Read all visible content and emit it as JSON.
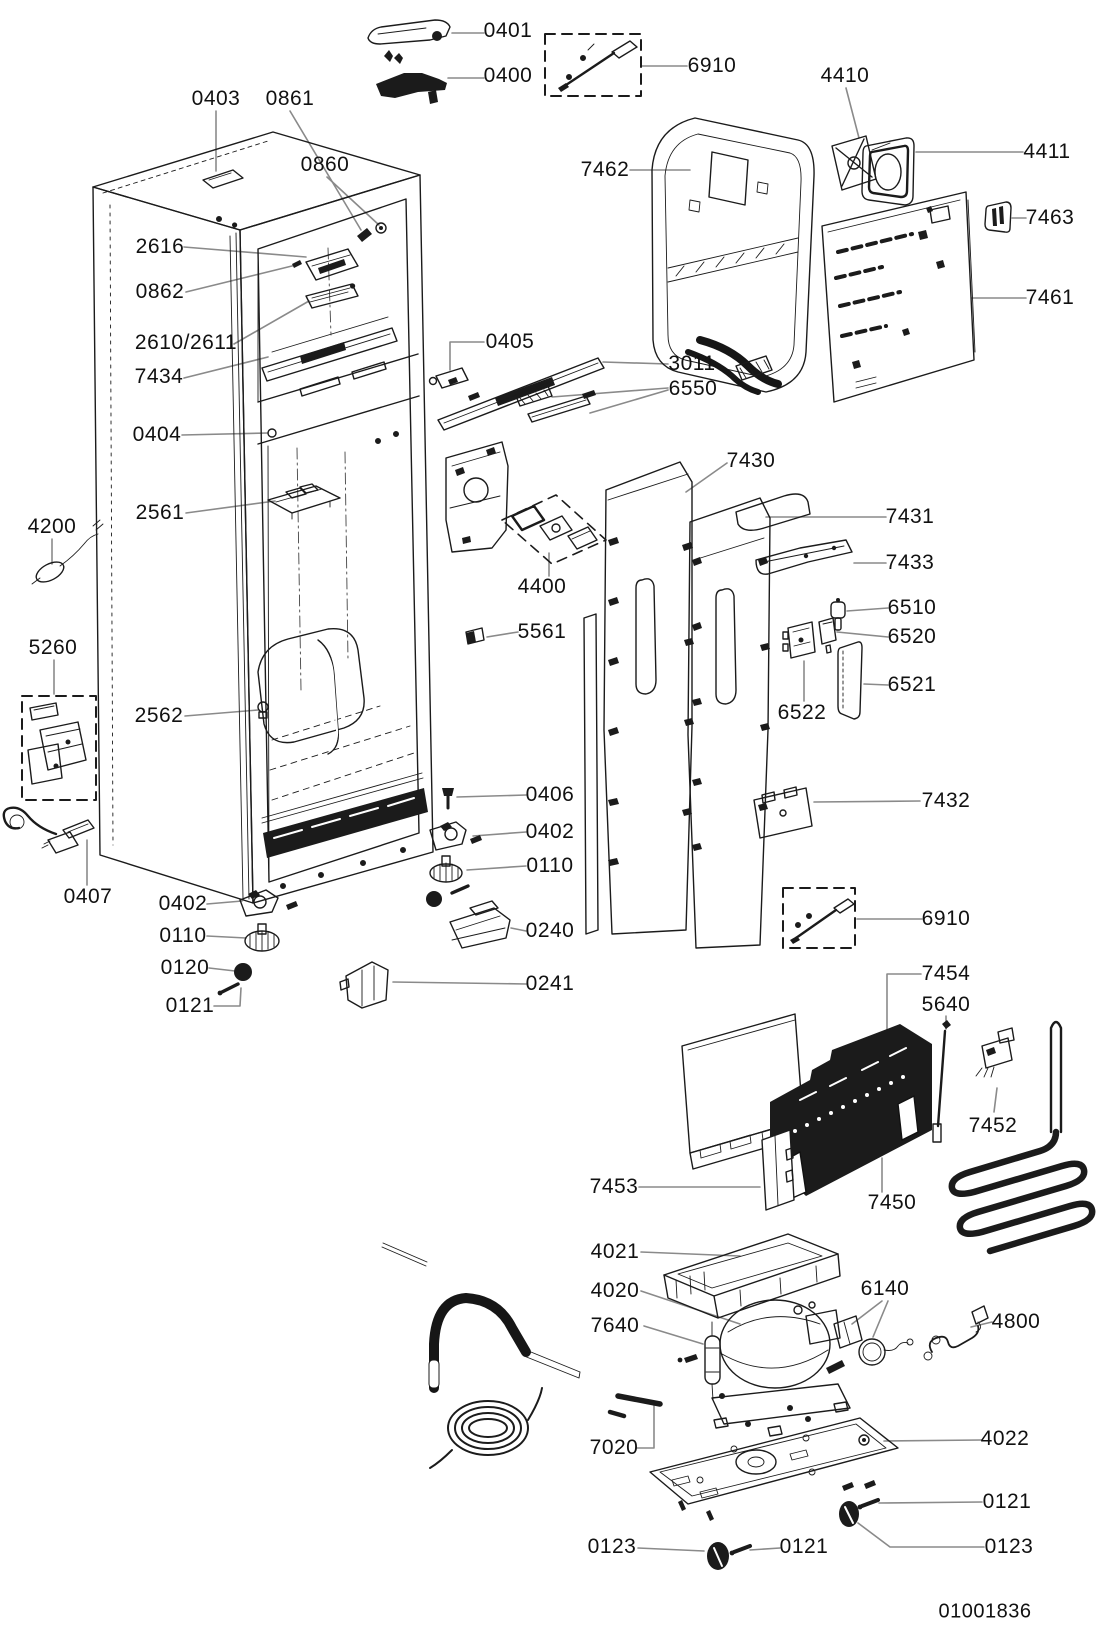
{
  "diagram": {
    "kind": "exploded-parts-diagram",
    "line_color": "#1b1b1b",
    "leader_color": "#8a8a8a",
    "background": "#ffffff"
  },
  "doc": {
    "code": "01001836"
  },
  "labels": [
    {
      "id": "0401",
      "text": "0401"
    },
    {
      "id": "0400",
      "text": "0400"
    },
    {
      "id": "6910-top",
      "text": "6910"
    },
    {
      "id": "4410",
      "text": "4410"
    },
    {
      "id": "7462",
      "text": "7462"
    },
    {
      "id": "4411",
      "text": "4411"
    },
    {
      "id": "7463",
      "text": "7463"
    },
    {
      "id": "7461",
      "text": "7461"
    },
    {
      "id": "0403",
      "text": "0403"
    },
    {
      "id": "0861",
      "text": "0861"
    },
    {
      "id": "0860",
      "text": "0860"
    },
    {
      "id": "2616",
      "text": "2616"
    },
    {
      "id": "0862",
      "text": "0862"
    },
    {
      "id": "2610-2611",
      "text": "2610/2611"
    },
    {
      "id": "7434",
      "text": "7434"
    },
    {
      "id": "0404",
      "text": "0404"
    },
    {
      "id": "0405",
      "text": "0405"
    },
    {
      "id": "3011",
      "text": "3011"
    },
    {
      "id": "6550",
      "text": "6550"
    },
    {
      "id": "7430",
      "text": "7430"
    },
    {
      "id": "7431",
      "text": "7431"
    },
    {
      "id": "7433",
      "text": "7433"
    },
    {
      "id": "6510",
      "text": "6510"
    },
    {
      "id": "6520",
      "text": "6520"
    },
    {
      "id": "6521",
      "text": "6521"
    },
    {
      "id": "6522",
      "text": "6522"
    },
    {
      "id": "4400",
      "text": "4400"
    },
    {
      "id": "5561",
      "text": "5561"
    },
    {
      "id": "4200",
      "text": "4200"
    },
    {
      "id": "5260",
      "text": "5260"
    },
    {
      "id": "2561",
      "text": "2561"
    },
    {
      "id": "2562",
      "text": "2562"
    },
    {
      "id": "7432",
      "text": "7432"
    },
    {
      "id": "0406",
      "text": "0406"
    },
    {
      "id": "0402-right",
      "text": "0402"
    },
    {
      "id": "0110-right",
      "text": "0110"
    },
    {
      "id": "0240",
      "text": "0240"
    },
    {
      "id": "0241",
      "text": "0241"
    },
    {
      "id": "0407",
      "text": "0407"
    },
    {
      "id": "0402-left",
      "text": "0402"
    },
    {
      "id": "0110-left",
      "text": "0110"
    },
    {
      "id": "0120",
      "text": "0120"
    },
    {
      "id": "0121-left",
      "text": "0121"
    },
    {
      "id": "6910-bottom",
      "text": "6910"
    },
    {
      "id": "7454",
      "text": "7454"
    },
    {
      "id": "5640",
      "text": "5640"
    },
    {
      "id": "7452",
      "text": "7452"
    },
    {
      "id": "7453",
      "text": "7453"
    },
    {
      "id": "7450",
      "text": "7450"
    },
    {
      "id": "4021",
      "text": "4021"
    },
    {
      "id": "4020",
      "text": "4020"
    },
    {
      "id": "7640",
      "text": "7640"
    },
    {
      "id": "6140",
      "text": "6140"
    },
    {
      "id": "4800",
      "text": "4800"
    },
    {
      "id": "7020",
      "text": "7020"
    },
    {
      "id": "4022",
      "text": "4022"
    },
    {
      "id": "0121-right",
      "text": "0121"
    },
    {
      "id": "0123-left",
      "text": "0123"
    },
    {
      "id": "0121-mid",
      "text": "0121"
    },
    {
      "id": "0123-right",
      "text": "0123"
    },
    {
      "id": "doc-code",
      "text": "01001836"
    }
  ]
}
